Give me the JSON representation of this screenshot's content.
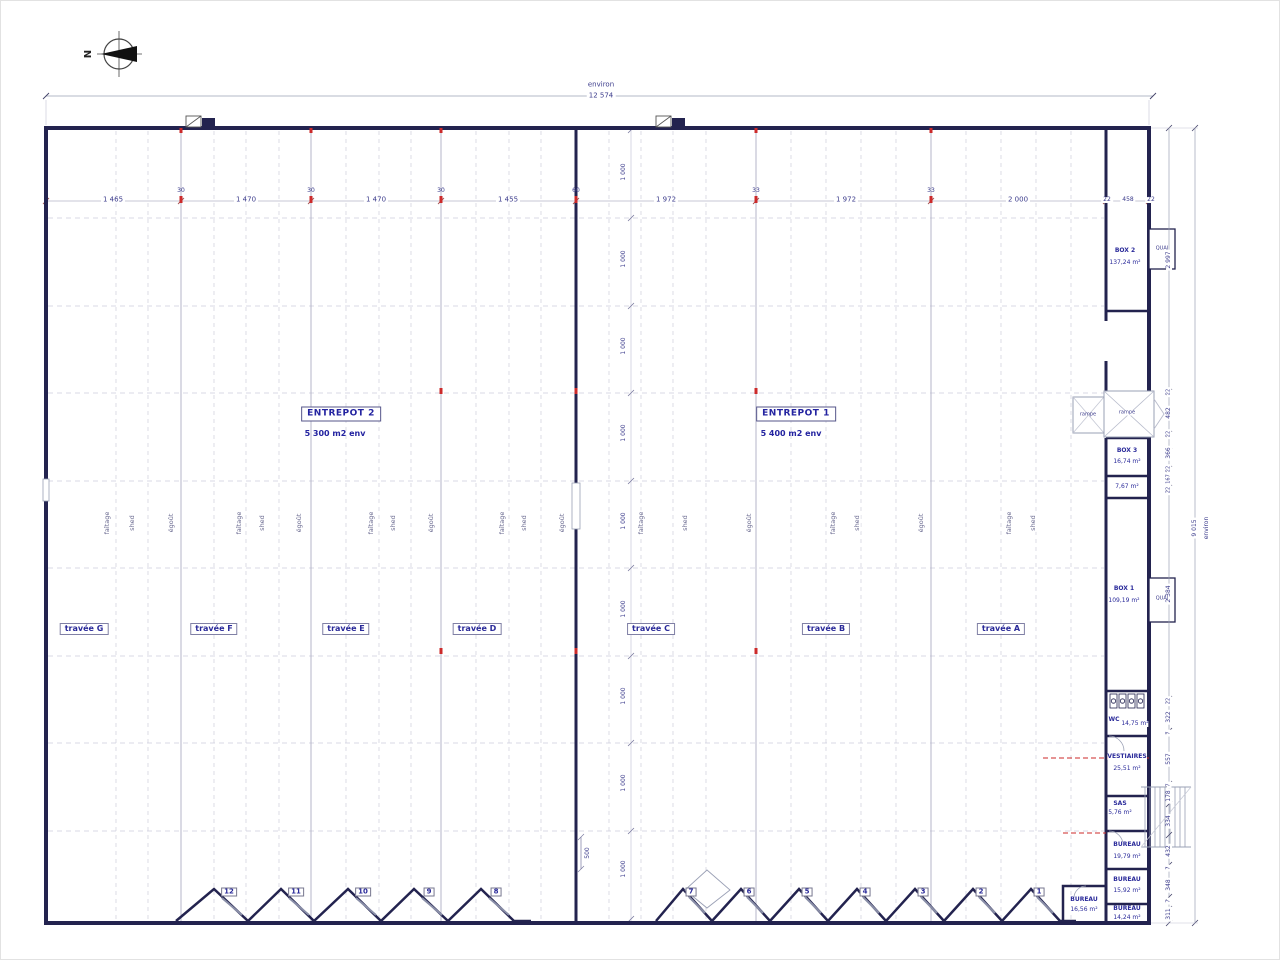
{
  "north": "N",
  "top_dim": {
    "word": "environ",
    "value": "12 574"
  },
  "top_row": [
    "1 465",
    "30",
    "1 470",
    "30",
    "1 470",
    "30",
    "1 455",
    "60",
    "1 972",
    "33",
    "1 972",
    "33",
    "2 000",
    "22",
    "458",
    "22"
  ],
  "v_bay": [
    "1 000",
    "1 000",
    "1 000",
    "1 000",
    "1 000",
    "1 000",
    "1 000",
    "1 000",
    "1 000"
  ],
  "v_500": "500",
  "right_chain": [
    "2 997",
    "22",
    "482",
    "22",
    "366",
    "22",
    "167",
    "22",
    "2 384",
    "22",
    "322",
    "7",
    "557",
    "7",
    "178",
    "334",
    "432",
    "7",
    "348",
    "7",
    "311"
  ],
  "right_outer": {
    "value": "9 015",
    "word": "environ"
  },
  "halls": [
    {
      "name": "ENTREPOT 2",
      "area": "5 300 m2 env"
    },
    {
      "name": "ENTREPOT 1",
      "area": "5 400 m2 env"
    }
  ],
  "travees": [
    "travée G",
    "travée F",
    "travée E",
    "travée D",
    "travée C",
    "travée B",
    "travée A"
  ],
  "roof": [
    "faîtage",
    "shed",
    "égoût",
    "faîtage",
    "shed",
    "égoût",
    "faîtage",
    "shed",
    "égoût",
    "faîtage",
    "shed",
    "égoût",
    "faîtage",
    "shed",
    "égoût",
    "faîtage",
    "shed",
    "égoût",
    "faîtage",
    "shed"
  ],
  "doors": [
    "12",
    "11",
    "10",
    "9",
    "8",
    "7",
    "6",
    "5",
    "4",
    "3",
    "2",
    "1"
  ],
  "rooms": {
    "box2": {
      "name": "BOX 2",
      "area": "137,24 m²"
    },
    "quai_top": "QUAI",
    "quai_mid": "QUAI",
    "rampe_left": "rampe",
    "rampe_right": "rampe",
    "box3": {
      "name": "BOX 3",
      "area": "16,74 m²"
    },
    "small_room": {
      "area": "7,67 m²"
    },
    "box1": {
      "name": "BOX 1",
      "area": "109,19 m²"
    },
    "wc": {
      "name": "WC",
      "area": "14,75 m²"
    },
    "vestiaires": {
      "name": "VESTIAIRES",
      "area": "25,51 m²"
    },
    "sas": {
      "name": "SAS",
      "area": "5,76 m²"
    },
    "bureau1": {
      "name": "BUREAU",
      "area": "19,79 m²"
    },
    "bureau2": {
      "name": "BUREAU",
      "area": "15,92 m²"
    },
    "bureau3": {
      "name": "BUREAU",
      "area": "14,24 m²"
    },
    "bureau4": {
      "name": "BUREAU",
      "area": "16,56 m²"
    }
  },
  "colors": {
    "wall": "#23234f",
    "text": "#3c3c8c",
    "grid": "#b4b4c8",
    "red": "#cc2a2a"
  }
}
